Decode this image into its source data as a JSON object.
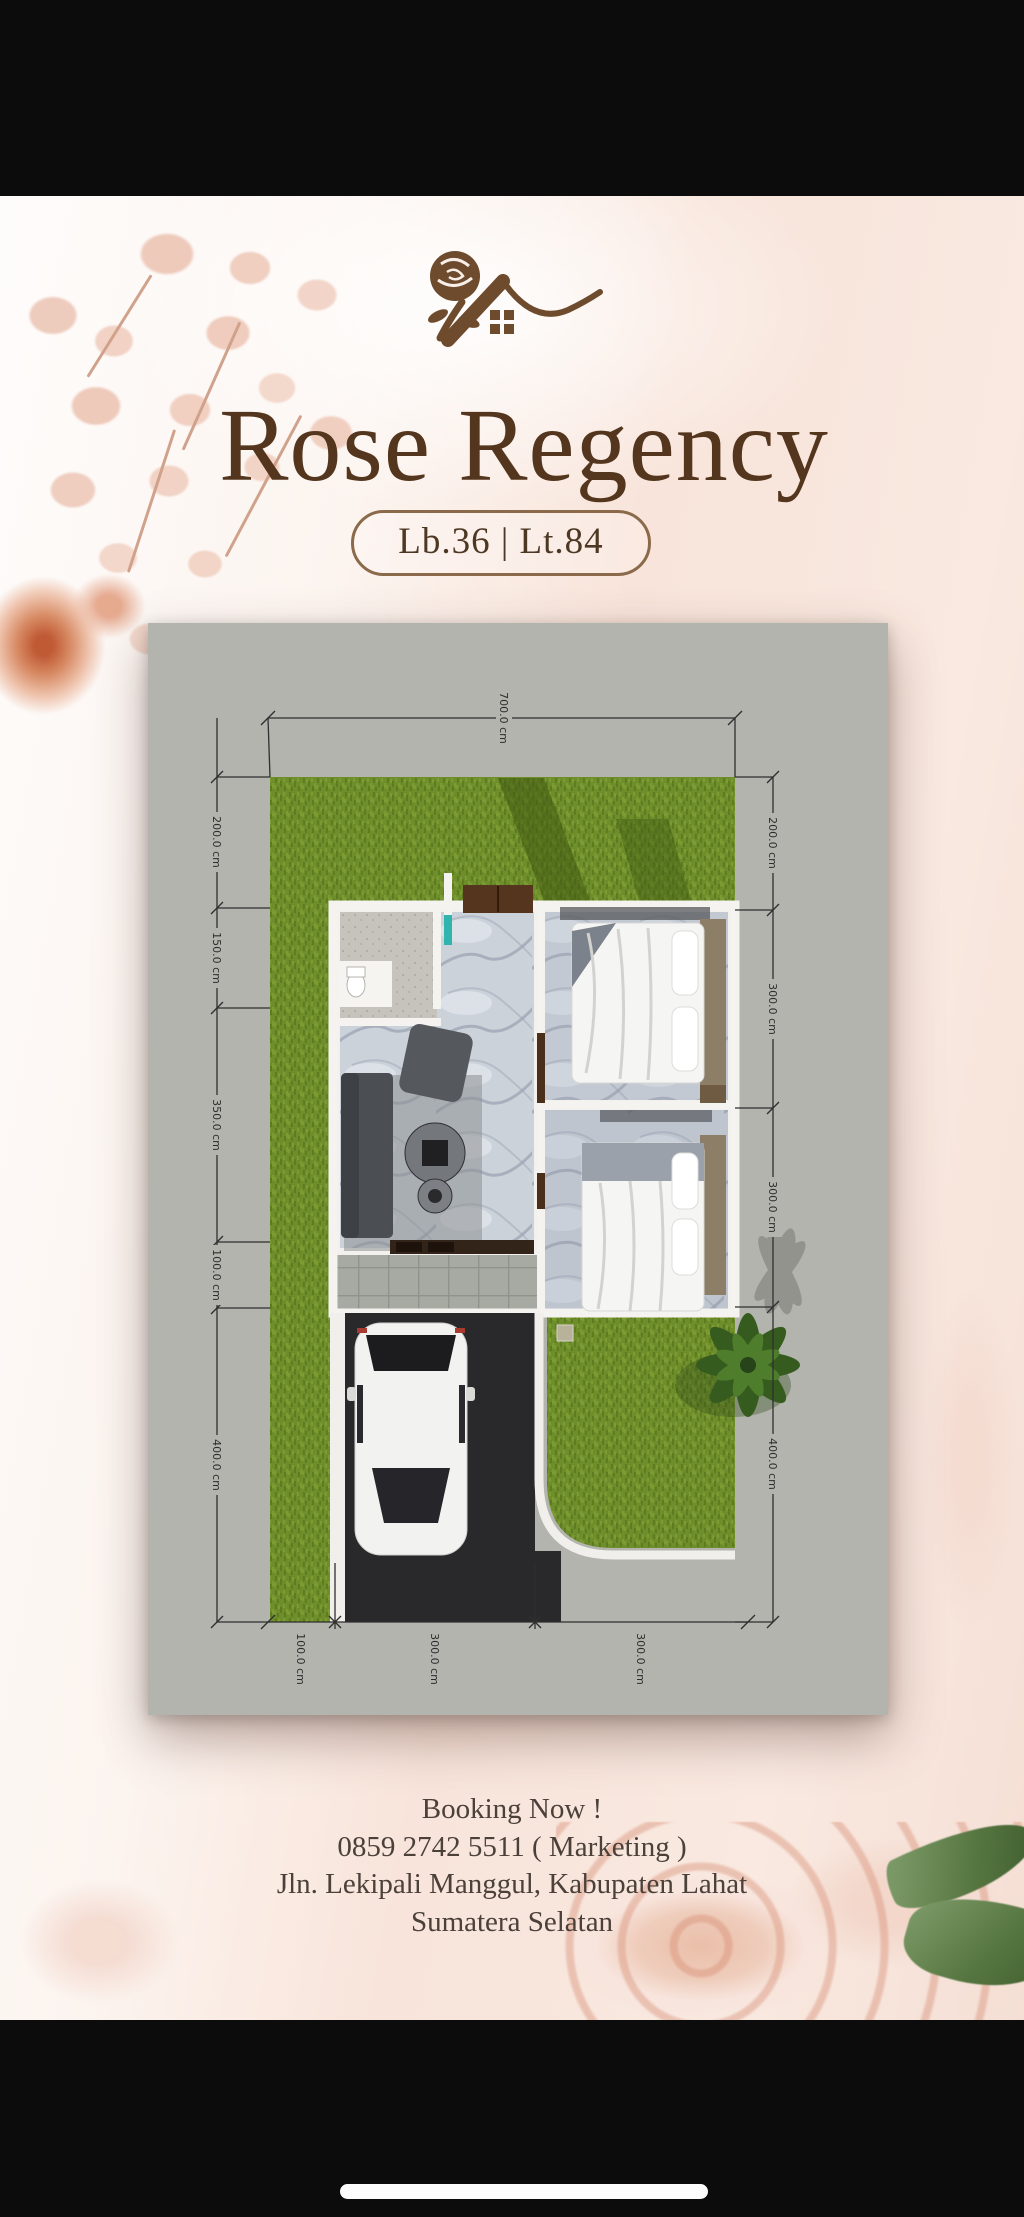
{
  "header": {
    "logo": "rose-house-logo",
    "title": "Rose Regency",
    "badge": "Lb.36 | Lt.84"
  },
  "floor_plan": {
    "dim_top": "700.0 cm",
    "dims_left": [
      "200.0 cm",
      "150.0 cm",
      "350.0 cm",
      "100.0 cm",
      "400.0 cm"
    ],
    "dims_right": [
      "200.0 cm",
      "300.0 cm",
      "300.0 cm",
      "400.0 cm"
    ],
    "dims_bottom": [
      "100.0 cm",
      "300.0 cm",
      "300.0 cm"
    ],
    "total_width_cm": 700,
    "total_depth_cm": 1200
  },
  "footer": {
    "line1": "Booking Now !",
    "line2": "0859 2742 5511 ( Marketing )",
    "line3": "Jln. Lekipali Manggul, Kabupaten Lahat",
    "line4": "Sumatera Selatan"
  },
  "colors": {
    "brand_brown": "#6d4b2c",
    "title_brown": "#53361d",
    "card_bg": "#b3b4ae",
    "grass_green": "#6e8d2b",
    "driveway": "#29292c",
    "teal_door": "#2fb5ae",
    "bar_black": "#0c0c0c"
  }
}
